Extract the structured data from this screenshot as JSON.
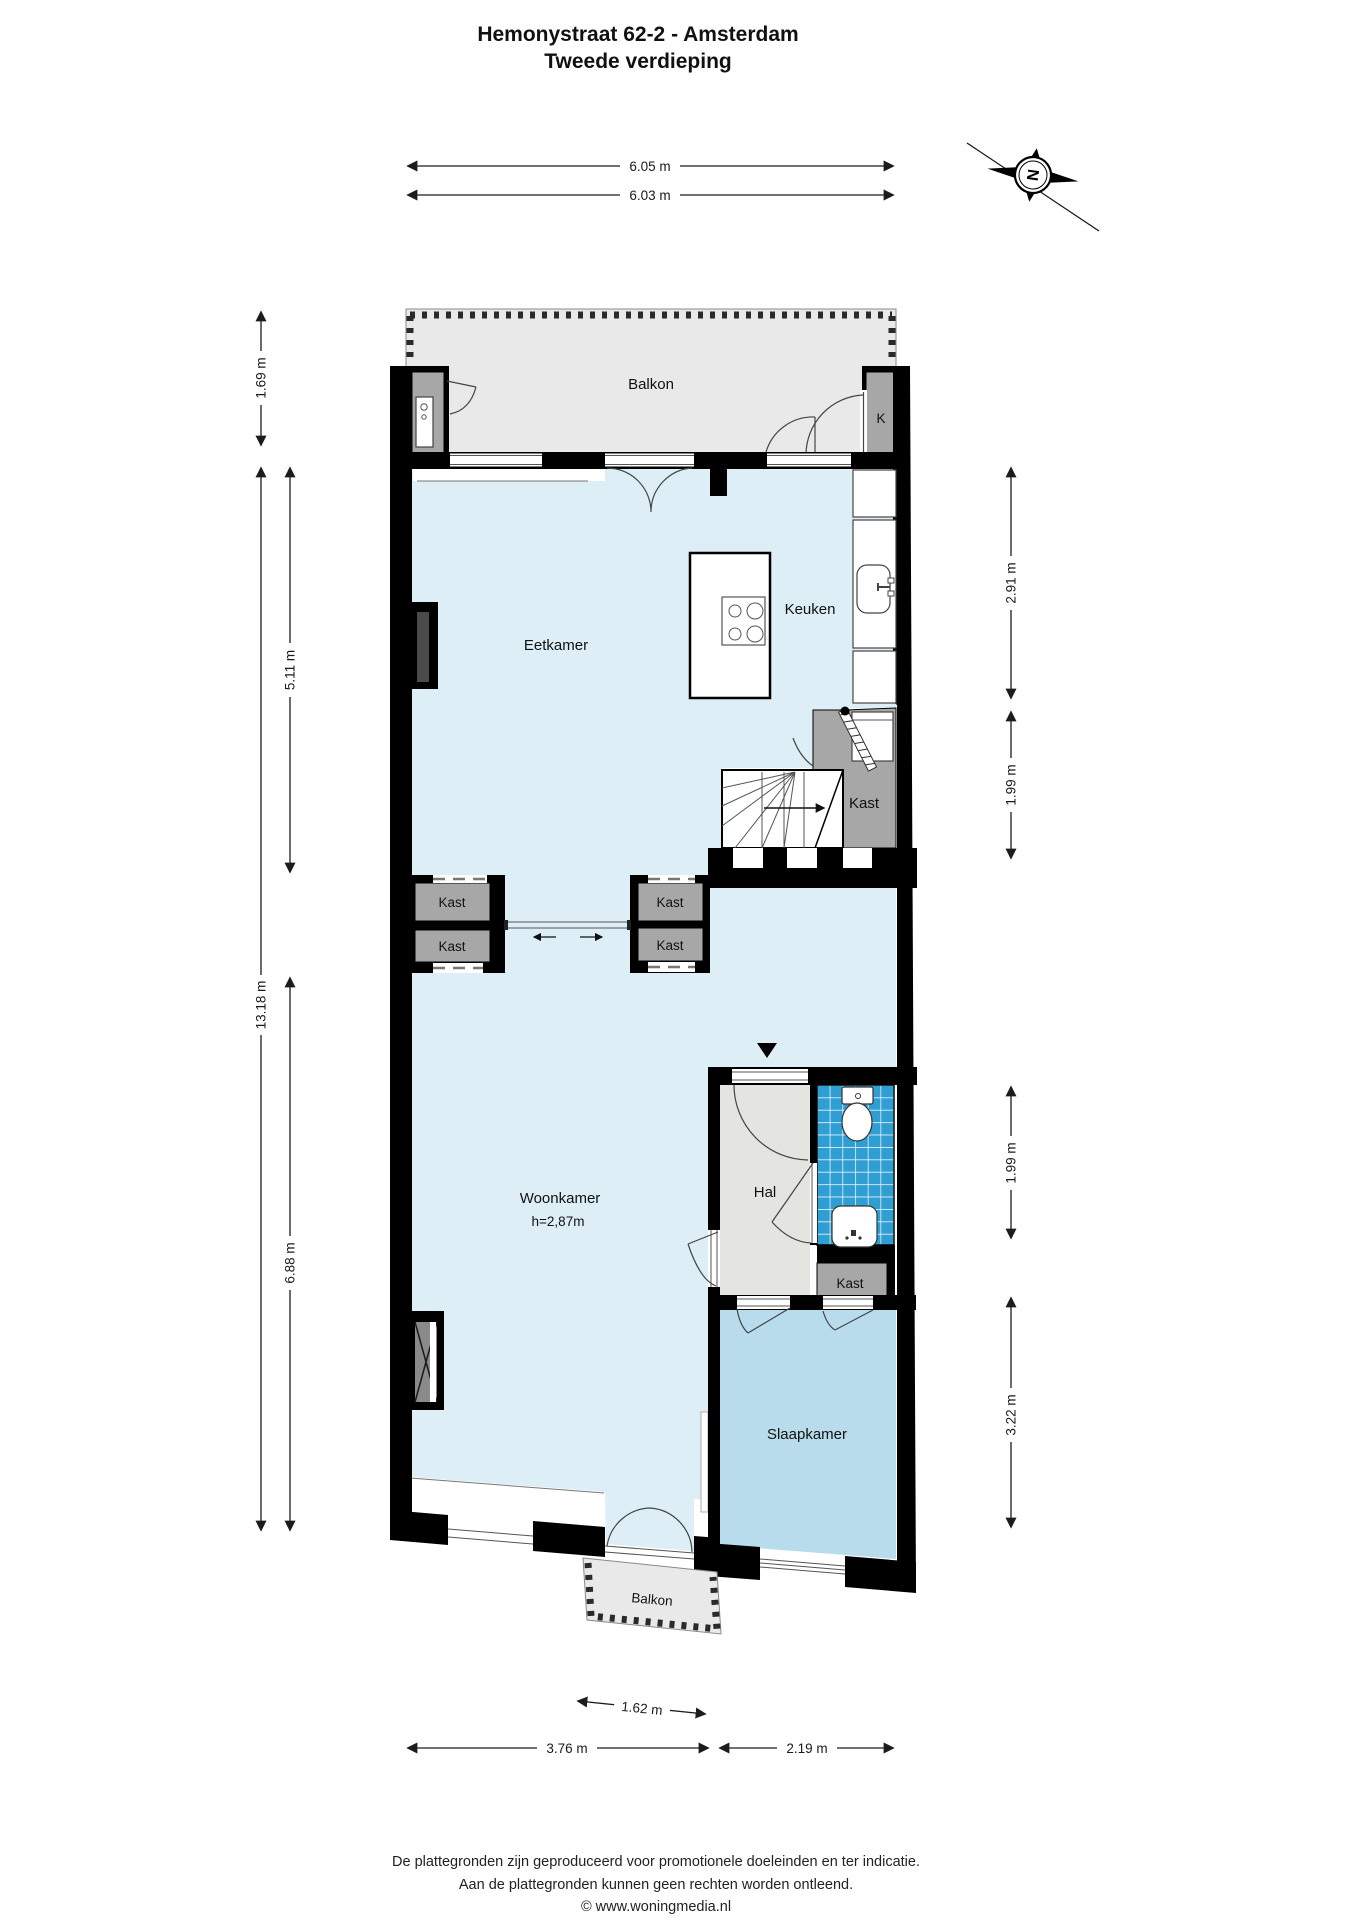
{
  "title": {
    "line1": "Hemonystraat 62-2 - Amsterdam",
    "line2": "Tweede verdieping"
  },
  "compass": {
    "letter": "N"
  },
  "rooms": {
    "balkon_top": "Balkon",
    "k_closet": "K",
    "eetkamer": "Eetkamer",
    "keuken": "Keuken",
    "kast_stairs": "Kast",
    "kast_divider_left_top": "Kast",
    "kast_divider_left_bottom": "Kast",
    "kast_divider_right_top": "Kast",
    "kast_divider_right_bottom": "Kast",
    "woonkamer": "Woonkamer",
    "woonkamer_height": "h=2,87m",
    "hal": "Hal",
    "kast_hal": "Kast",
    "slaapkamer": "Slaapkamer",
    "balkon_bottom": "Balkon"
  },
  "dimensions": {
    "top": [
      "6.05 m",
      "6.03 m"
    ],
    "left": [
      "1.69 m",
      "5.11 m",
      "13.18 m",
      "6.88 m"
    ],
    "right": [
      "2.91 m",
      "1.99 m",
      "1.99 m",
      "3.22 m"
    ],
    "bottom": [
      "1.62 m",
      "3.76 m",
      "2.19 m"
    ]
  },
  "footer": {
    "line1": "De plattegronden zijn geproduceerd voor promotionele doeleinden en ter indicatie.",
    "line2": "Aan de plattegronden kunnen geen rechten worden ontleend.",
    "line3": "© www.woningmedia.nl"
  },
  "colors": {
    "wall": "#000000",
    "floor_main": "#ddeef6",
    "floor_bedroom": "#b9dcec",
    "floor_hall": "#e4e4e0",
    "balcony": "#e9e9e9",
    "closet_gray": "#a7a7a7",
    "tile_blue": "#2e9ed3"
  }
}
